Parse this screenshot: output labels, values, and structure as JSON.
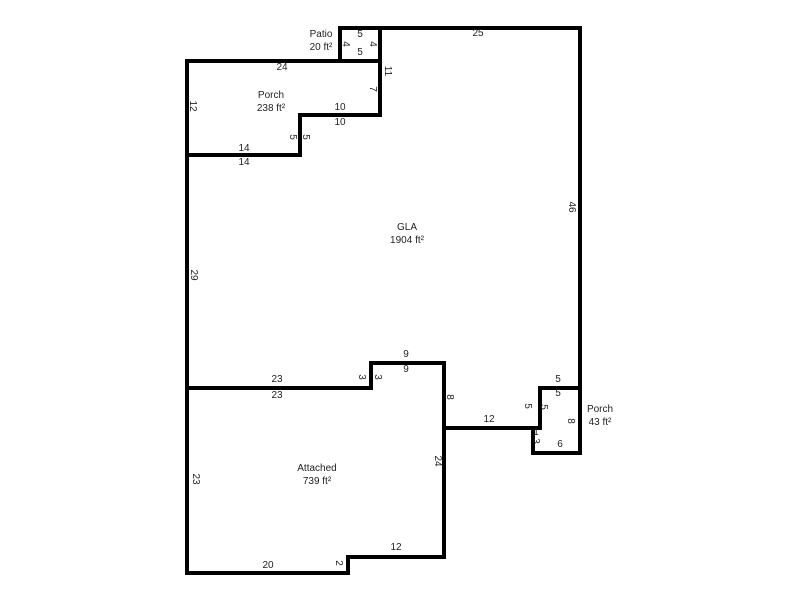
{
  "figure": {
    "type": "floorplan-sketch",
    "background_color": "#ffffff",
    "wall_color": "#000000",
    "text_color": "#1f1f1f"
  },
  "rooms": [
    {
      "id": "patio",
      "name": "Patio",
      "area": "20 ft²"
    },
    {
      "id": "porch-left",
      "name": "Porch",
      "area": "238 ft²"
    },
    {
      "id": "gla",
      "name": "GLA",
      "area": "1904 ft²"
    },
    {
      "id": "attached",
      "name": "Attached",
      "area": "739 ft²"
    },
    {
      "id": "porch-right",
      "name": "Porch",
      "area": "43 ft²"
    }
  ],
  "shapes": {
    "patio": {
      "points": "340,28 380,28 380,61 340,61"
    },
    "porch_left": {
      "points": "187,61 380,61 380,115 300,115 300,155 187,155"
    },
    "gla": {
      "points": "380,28 580,28 580,388 540,388 540,428 444,428 444,363 371,363 371,388 187,388 187,155 300,155 300,115 380,115"
    },
    "attached": {
      "points": "187,388 371,388 371,363 444,363 444,557 348,557 348,573 187,573"
    },
    "porch_right": {
      "points": "540,388 580,388 580,453 533,453 533,428 540,428"
    }
  },
  "dimensions": [
    {
      "text": "25",
      "x": 478,
      "y": 34,
      "rot": false
    },
    {
      "text": "5",
      "x": 360,
      "y": 35,
      "rot": false
    },
    {
      "text": "4",
      "x": 345,
      "y": 44,
      "rot": true
    },
    {
      "text": "4",
      "x": 372,
      "y": 44,
      "rot": true
    },
    {
      "text": "5",
      "x": 360,
      "y": 53,
      "rot": false
    },
    {
      "text": "11",
      "x": 387,
      "y": 71,
      "rot": true
    },
    {
      "text": "7",
      "x": 372,
      "y": 89,
      "rot": true
    },
    {
      "text": "24",
      "x": 282,
      "y": 68,
      "rot": false
    },
    {
      "text": "12",
      "x": 192,
      "y": 106,
      "rot": true
    },
    {
      "text": "10",
      "x": 340,
      "y": 108,
      "rot": false
    },
    {
      "text": "10",
      "x": 340,
      "y": 123,
      "rot": false
    },
    {
      "text": "5",
      "x": 292,
      "y": 137,
      "rot": true
    },
    {
      "text": "5",
      "x": 305,
      "y": 137,
      "rot": true
    },
    {
      "text": "14",
      "x": 244,
      "y": 149,
      "rot": false
    },
    {
      "text": "14",
      "x": 244,
      "y": 163,
      "rot": false
    },
    {
      "text": "29",
      "x": 193,
      "y": 275,
      "rot": true
    },
    {
      "text": "46",
      "x": 571,
      "y": 207,
      "rot": true
    },
    {
      "text": "23",
      "x": 277,
      "y": 380,
      "rot": false
    },
    {
      "text": "23",
      "x": 277,
      "y": 396,
      "rot": false
    },
    {
      "text": "3",
      "x": 361,
      "y": 377,
      "rot": true
    },
    {
      "text": "3",
      "x": 377,
      "y": 377,
      "rot": true
    },
    {
      "text": "9",
      "x": 406,
      "y": 355,
      "rot": false
    },
    {
      "text": "9",
      "x": 406,
      "y": 370,
      "rot": false
    },
    {
      "text": "8",
      "x": 449,
      "y": 397,
      "rot": true
    },
    {
      "text": "5",
      "x": 558,
      "y": 380,
      "rot": false
    },
    {
      "text": "5",
      "x": 558,
      "y": 394,
      "rot": false
    },
    {
      "text": "5",
      "x": 527,
      "y": 406,
      "rot": true
    },
    {
      "text": "5",
      "x": 543,
      "y": 407,
      "rot": true
    },
    {
      "text": "12",
      "x": 489,
      "y": 420,
      "rot": false
    },
    {
      "text": "8",
      "x": 570,
      "y": 421,
      "rot": true
    },
    {
      "text": "1",
      "x": 536,
      "y": 433,
      "rot": false
    },
    {
      "text": "3",
      "x": 535,
      "y": 441,
      "rot": true
    },
    {
      "text": "6",
      "x": 560,
      "y": 445,
      "rot": false
    },
    {
      "text": "24",
      "x": 437,
      "y": 461,
      "rot": true
    },
    {
      "text": "23",
      "x": 195,
      "y": 479,
      "rot": true
    },
    {
      "text": "12",
      "x": 396,
      "y": 548,
      "rot": false
    },
    {
      "text": "2",
      "x": 338,
      "y": 563,
      "rot": true
    },
    {
      "text": "20",
      "x": 268,
      "y": 566,
      "rot": false
    }
  ]
}
